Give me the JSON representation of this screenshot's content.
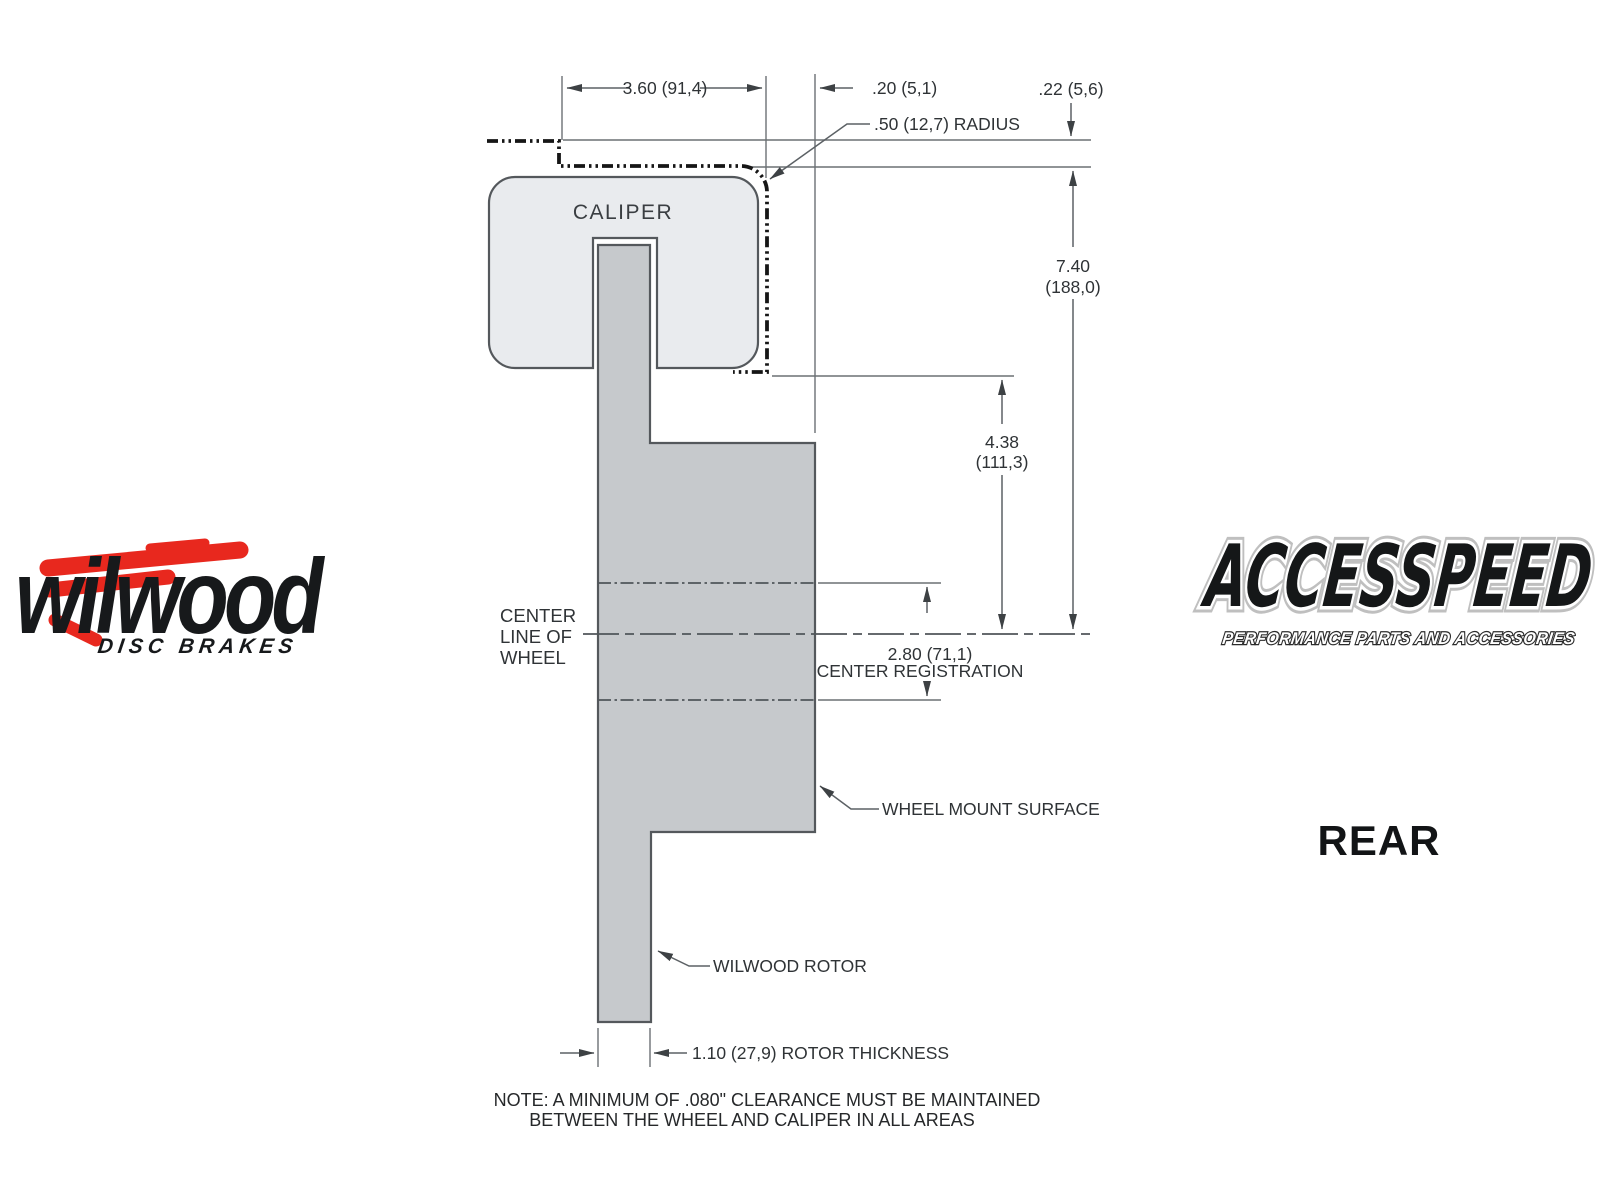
{
  "colors": {
    "caliper_fill": "#e9ebee",
    "rotor_fill": "#c6c9cc",
    "outline": "#54585c",
    "dim_line": "#6b7074",
    "text": "#2f3336",
    "wheel_dash": "#161616",
    "wilwood_red": "#e8281e",
    "logo_black": "#17191b"
  },
  "diagram": {
    "caliper_label": "CALIPER",
    "dimensions": {
      "width_3_60": "3.60 (91,4)",
      "gap_0_20": ".20 (5,1)",
      "step_0_22": ".22 (5,6)",
      "radius_0_50": ".50 (12,7) RADIUS",
      "height_7_40_in": "7.40",
      "height_7_40_mm": "(188,0)",
      "depth_4_38_in": "4.38",
      "depth_4_38_mm": "(111,3)",
      "center_reg_value": "2.80 (71,1)",
      "center_reg_label": "CENTER REGISTRATION",
      "rotor_thickness": "1.10 (27,9) ROTOR THICKNESS"
    },
    "labels": {
      "centerline_line1": "CENTER",
      "centerline_line2": "LINE OF",
      "centerline_line3": "WHEEL",
      "wheel_mount_surface": "WHEEL MOUNT SURFACE",
      "wilwood_rotor": "WILWOOD ROTOR"
    },
    "note_line1": "NOTE: A MINIMUM OF .080\" CLEARANCE MUST BE MAINTAINED",
    "note_line2": "BETWEEN THE WHEEL AND CALIPER IN ALL AREAS"
  },
  "branding": {
    "wilwood_script": "wilwood",
    "wilwood_sub": "DISC BRAKES",
    "accesspeed_name": "ACCESSPEED",
    "accesspeed_tagline": "PERFORMANCE PARTS AND ACCESSORIES",
    "view_label": "REAR"
  }
}
